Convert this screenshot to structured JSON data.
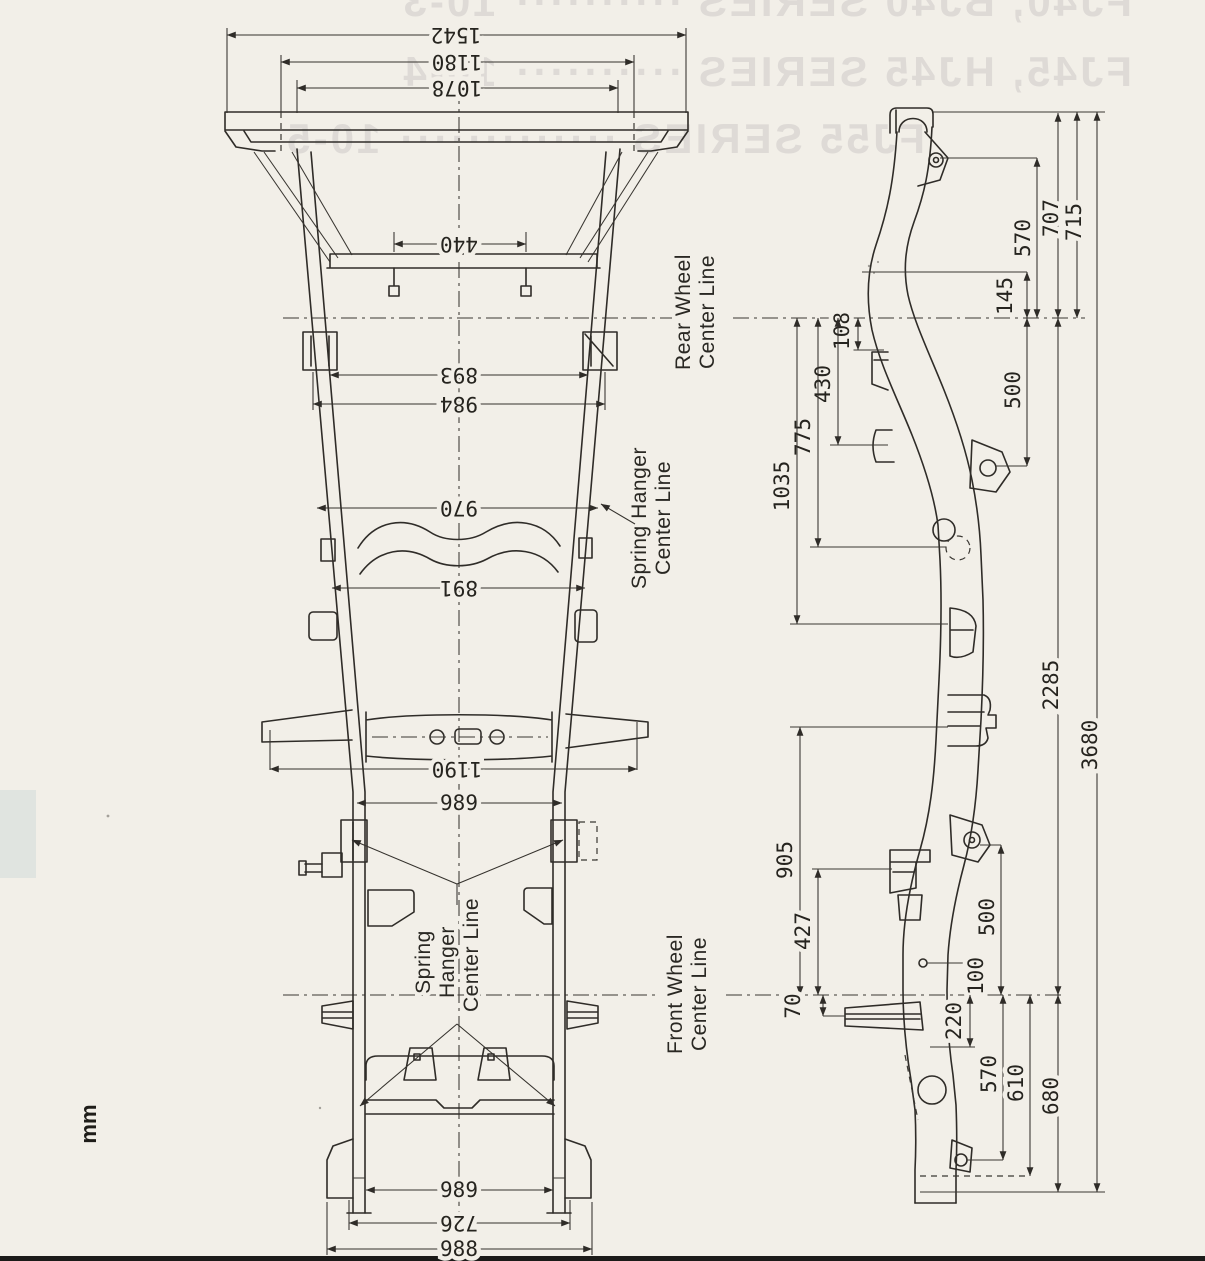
{
  "page": {
    "unit_label": "mm"
  },
  "bleedthrough": {
    "lines": [
      "FJ40, BJ40 SERIES ·········· 10-3",
      "FJ45, HJ45 SERIES ·········· 10-4",
      "FJ55 SERIES ············· 10-5"
    ]
  },
  "labels": {
    "rear_wheel_line1": "Rear Wheel",
    "rear_wheel_line2": "Center Line",
    "spring_hanger_rear_line1": "Spring Hanger",
    "spring_hanger_rear_line2": "Center Line",
    "spring_hanger_front_line1": "Spring",
    "spring_hanger_front_line2": "Hanger",
    "spring_hanger_front_line3": "Center Line",
    "front_wheel_line1": "Front Wheel",
    "front_wheel_line2": "Center Line"
  },
  "plan_view": {
    "dims": {
      "overall_rear_width": "1542",
      "rear_bolt_span": "1180",
      "rear_inner_span": "1078",
      "crossmember_bolt_span": "440",
      "span_893": "893",
      "span_984": "984",
      "span_970": "970",
      "span_891": "891",
      "outrigger_span": "1190",
      "mid_rail_span": "989",
      "front_rail_span": "989",
      "front_span_726": "726",
      "front_span_988": "988"
    }
  },
  "side_view": {
    "dims": {
      "d570_top": "570",
      "d707": "707",
      "d715": "715",
      "d145": "145",
      "d108": "108",
      "d430": "430",
      "d775": "775",
      "d1035": "1035",
      "d500_upper": "500",
      "d2285": "2285",
      "d3680": "3680",
      "d905": "905",
      "d427": "427",
      "d500_lower": "500",
      "d100": "100",
      "d70": "70",
      "d220": "220",
      "d570_bottom": "570",
      "d610": "610",
      "d680": "680"
    }
  }
}
